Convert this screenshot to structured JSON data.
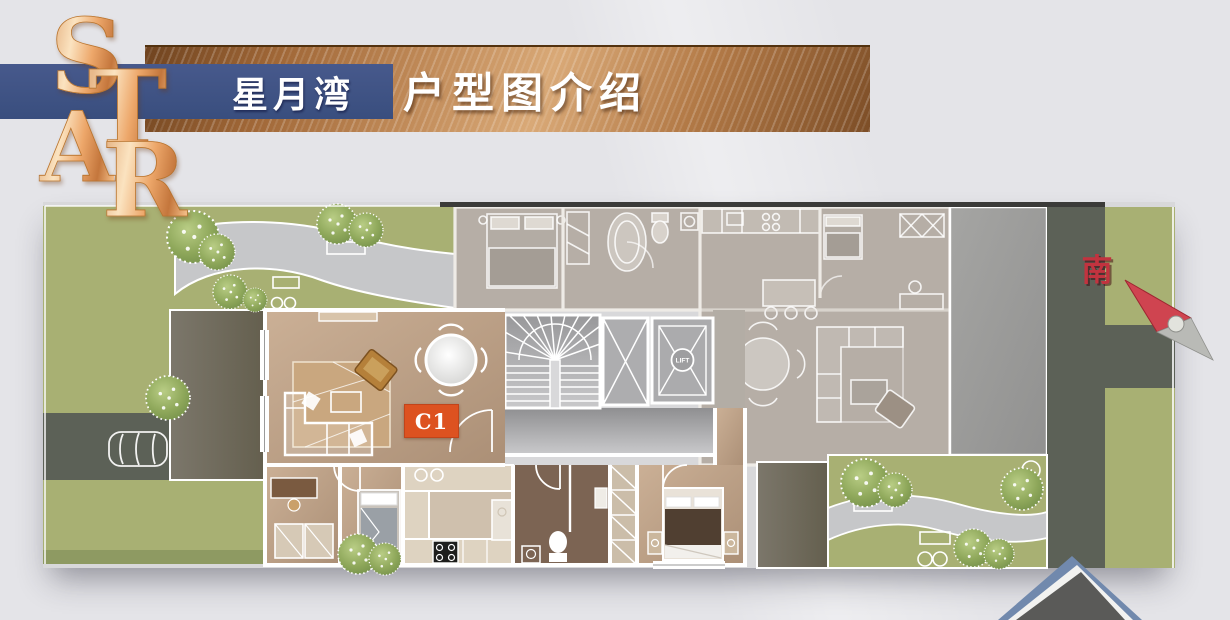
{
  "logo": {
    "name": "STAR",
    "letters": [
      "S",
      "T",
      "A",
      "R"
    ]
  },
  "header": {
    "project_name": "星月湾",
    "title": "户型图介绍"
  },
  "floor_plan": {
    "unit_label": "C1",
    "lift_label": "LIFT",
    "compass": {
      "south_label": "南"
    }
  },
  "colors": {
    "background": "#e4e4e8",
    "ribbon_navy": "#3e5383",
    "copper": "#b77e4e",
    "unit_badge_orange": "#dd5220",
    "lawn_green": "#a8b073",
    "road_gray": "#5c6157",
    "compass_red": "#c2333f",
    "wood_floor": "#c0a188",
    "ghost_floor": "#b6aea6"
  }
}
